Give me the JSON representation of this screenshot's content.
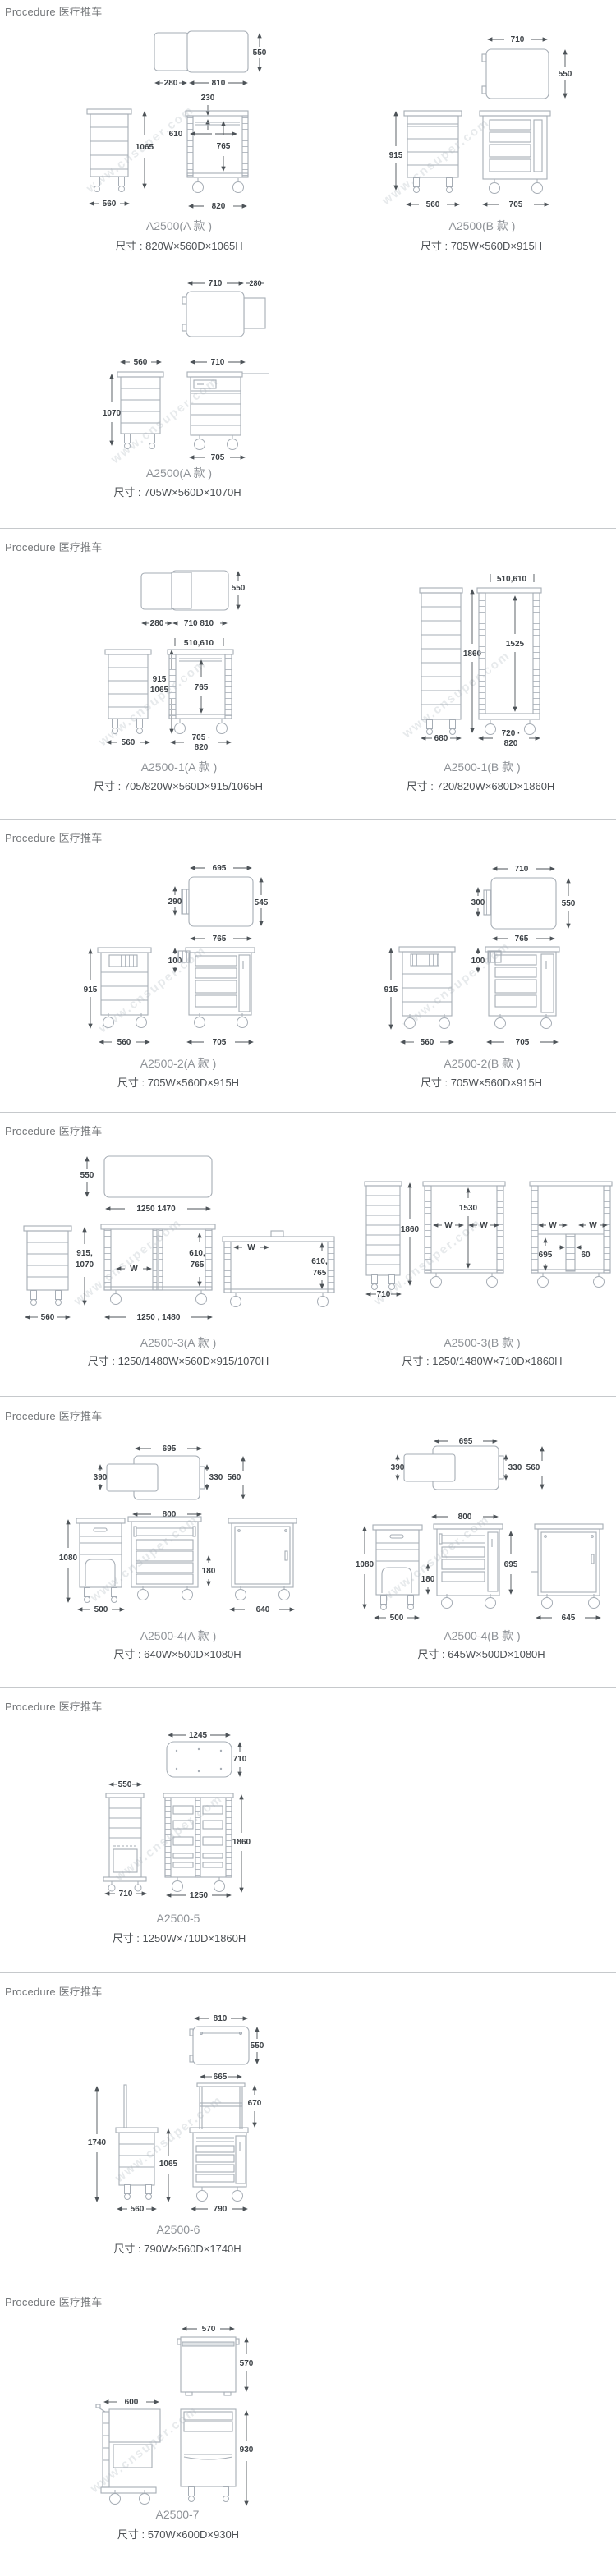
{
  "page": {
    "section_header": "Procedure 医疗推车",
    "watermark": "www.cnsuper.com"
  },
  "sections": [
    {
      "products": [
        {
          "model": "A2500(A 款 )",
          "size": "尺寸 : 820W×560D×1065H",
          "dims": [
            "550",
            "280",
            "810",
            "230",
            "1065",
            "560",
            "610",
            "765",
            "820"
          ]
        },
        {
          "model": "A2500(B 款 )",
          "size": "尺寸 : 705W×560D×915H",
          "dims": [
            "710",
            "550",
            "915",
            "560",
            "705"
          ]
        },
        {
          "model": "A2500(A 款 )",
          "size": "尺寸 : 705W×560D×1070H",
          "dims": [
            "710",
            "280",
            "560",
            "710",
            "1070",
            "705"
          ]
        }
      ]
    },
    {
      "products": [
        {
          "model": "A2500-1(A 款 )",
          "size": "尺寸 : 705/820W×560D×915/1065H",
          "dims": [
            "550",
            "280",
            "710 810",
            "510,610",
            "915",
            "1065",
            "765",
            "560",
            "705 ·",
            "820"
          ]
        },
        {
          "model": "A2500-1(B 款 )",
          "size": "尺寸 : 720/820W×680D×1860H",
          "dims": [
            "510,610",
            "1860",
            "1525",
            "680",
            "720 ·",
            "820"
          ]
        }
      ]
    },
    {
      "products": [
        {
          "model": "A2500-2(A 款 )",
          "size": "尺寸 : 705W×560D×915H",
          "dims": [
            "695",
            "290",
            "545",
            "765",
            "100",
            "915",
            "560",
            "705"
          ]
        },
        {
          "model": "A2500-2(B 款 )",
          "size": "尺寸 : 705W×560D×915H",
          "dims": [
            "710",
            "300",
            "550",
            "765",
            "100",
            "915",
            "560",
            "705"
          ]
        }
      ]
    },
    {
      "products": [
        {
          "model": "A2500-3(A 款 )",
          "size": "尺寸 : 1250/1480W×560D×915/1070H",
          "dims": [
            "550",
            "1250 1470",
            "915,",
            "1070",
            "560",
            "W",
            "610,",
            "765",
            "1250 , 1480",
            "W",
            "610,",
            "765"
          ]
        },
        {
          "model": "A2500-3(B 款 )",
          "size": "尺寸 : 1250/1480W×710D×1860H",
          "dims": [
            "1860",
            "710",
            "1530",
            "W",
            "W",
            "W",
            "W",
            "695",
            "60"
          ]
        }
      ]
    },
    {
      "products": [
        {
          "model": "A2500-4(A 款 )",
          "size": "尺寸 : 640W×500D×1080H",
          "dims": [
            "695",
            "390",
            "330",
            "560",
            "800",
            "1080",
            "500",
            "180",
            "640"
          ]
        },
        {
          "model": "A2500-4(B 款 )",
          "size": "尺寸 : 645W×500D×1080H",
          "dims": [
            "695",
            "390",
            "330",
            "560",
            "800",
            "1080",
            "180",
            "500",
            "695",
            "645"
          ]
        }
      ]
    },
    {
      "products": [
        {
          "model": "A2500-5",
          "size": "尺寸 : 1250W×710D×1860H",
          "dims": [
            "1245",
            "710",
            "550",
            "710",
            "1860",
            "1250"
          ]
        }
      ]
    },
    {
      "products": [
        {
          "model": "A2500-6",
          "size": "尺寸 : 790W×560D×1740H",
          "dims": [
            "810",
            "550",
            "665",
            "670",
            "1740",
            "1065",
            "560",
            "790"
          ]
        }
      ]
    },
    {
      "products": [
        {
          "model": "A2500-7",
          "size": "尺寸 : 570W×600D×930H",
          "dims": [
            "570",
            "570",
            "600",
            "930"
          ]
        }
      ]
    }
  ]
}
